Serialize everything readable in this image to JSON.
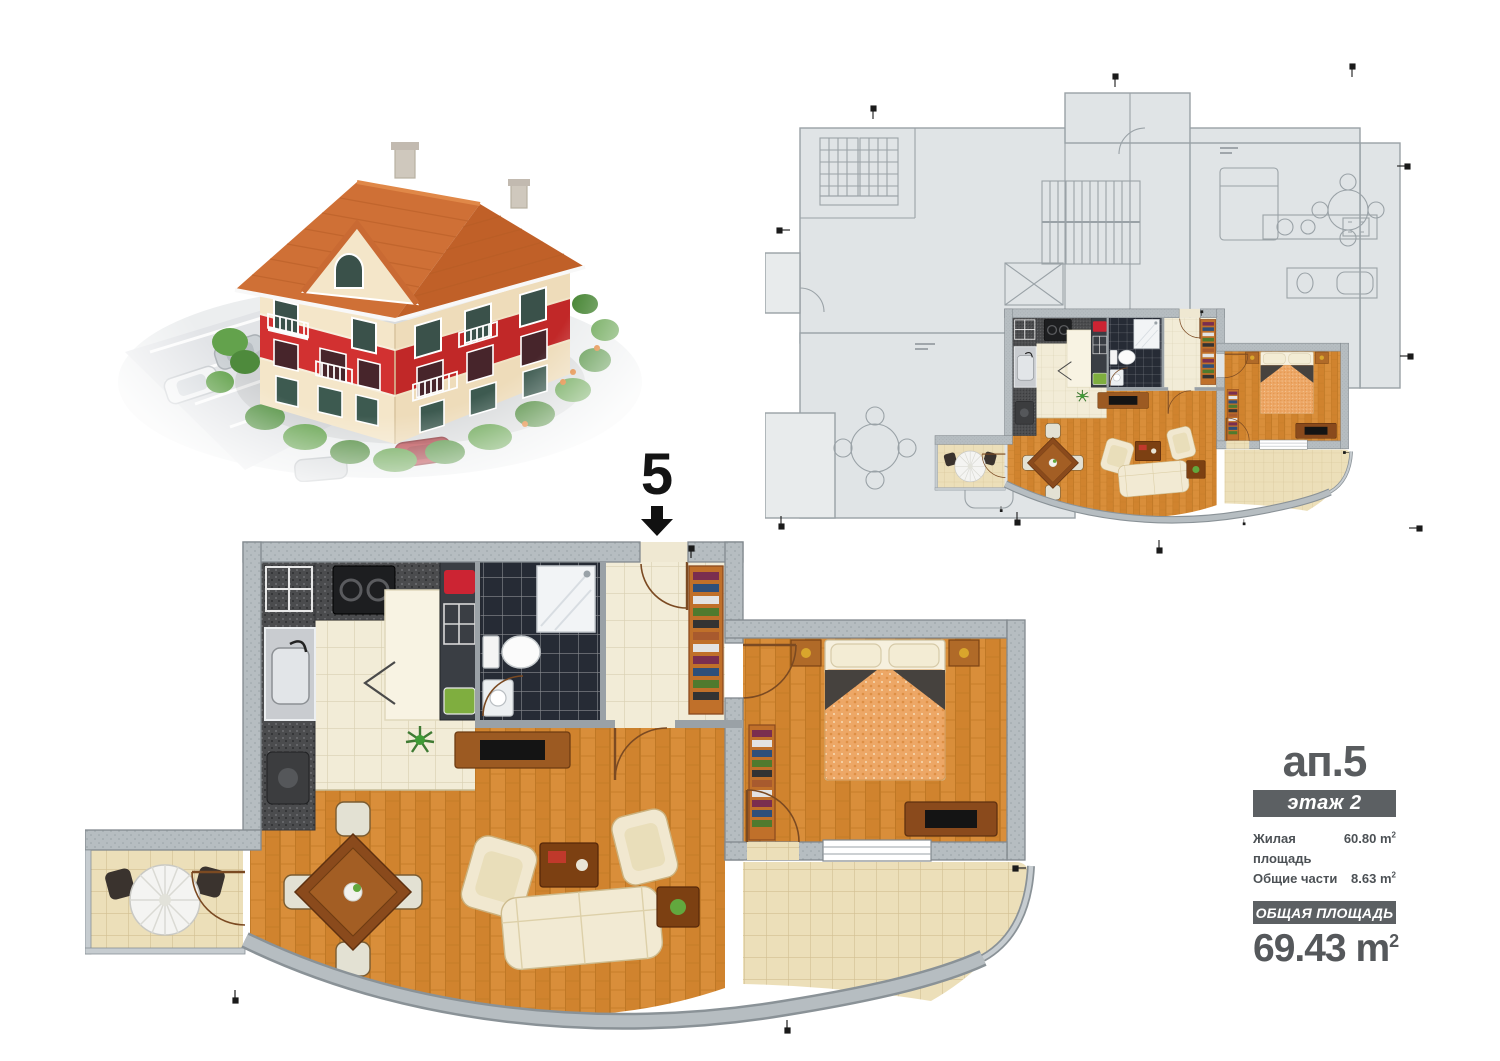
{
  "apartment_marker": {
    "number": "5"
  },
  "info_panel": {
    "title": "ап.5",
    "floor_label": "этаж 2",
    "areas": [
      {
        "label": "Жилая площадь",
        "value": "60.80",
        "unit": "m",
        "sup": "2"
      },
      {
        "label": "Общие части",
        "value": "8.63",
        "unit": "m",
        "sup": "2"
      }
    ],
    "total_label": "ОБЩАЯ ПЛОЩАДЬ",
    "total_value": "69.43",
    "total_unit": "m",
    "total_sup": "2"
  },
  "colors": {
    "panel_bar": "#5c6063",
    "panel_text": "#55585b",
    "wood_floor": "#d0832e",
    "kitchen_tile": "#f2ecd7",
    "terrace_tile": "#ecdfb9",
    "bathroom_tile": "#262b35",
    "plan_wall": "#b6bdc1",
    "overview_floor": "#e0e4e6",
    "roof": "#cf7036",
    "facade_red": "#d23131",
    "facade_cream": "#f4e6c9"
  }
}
